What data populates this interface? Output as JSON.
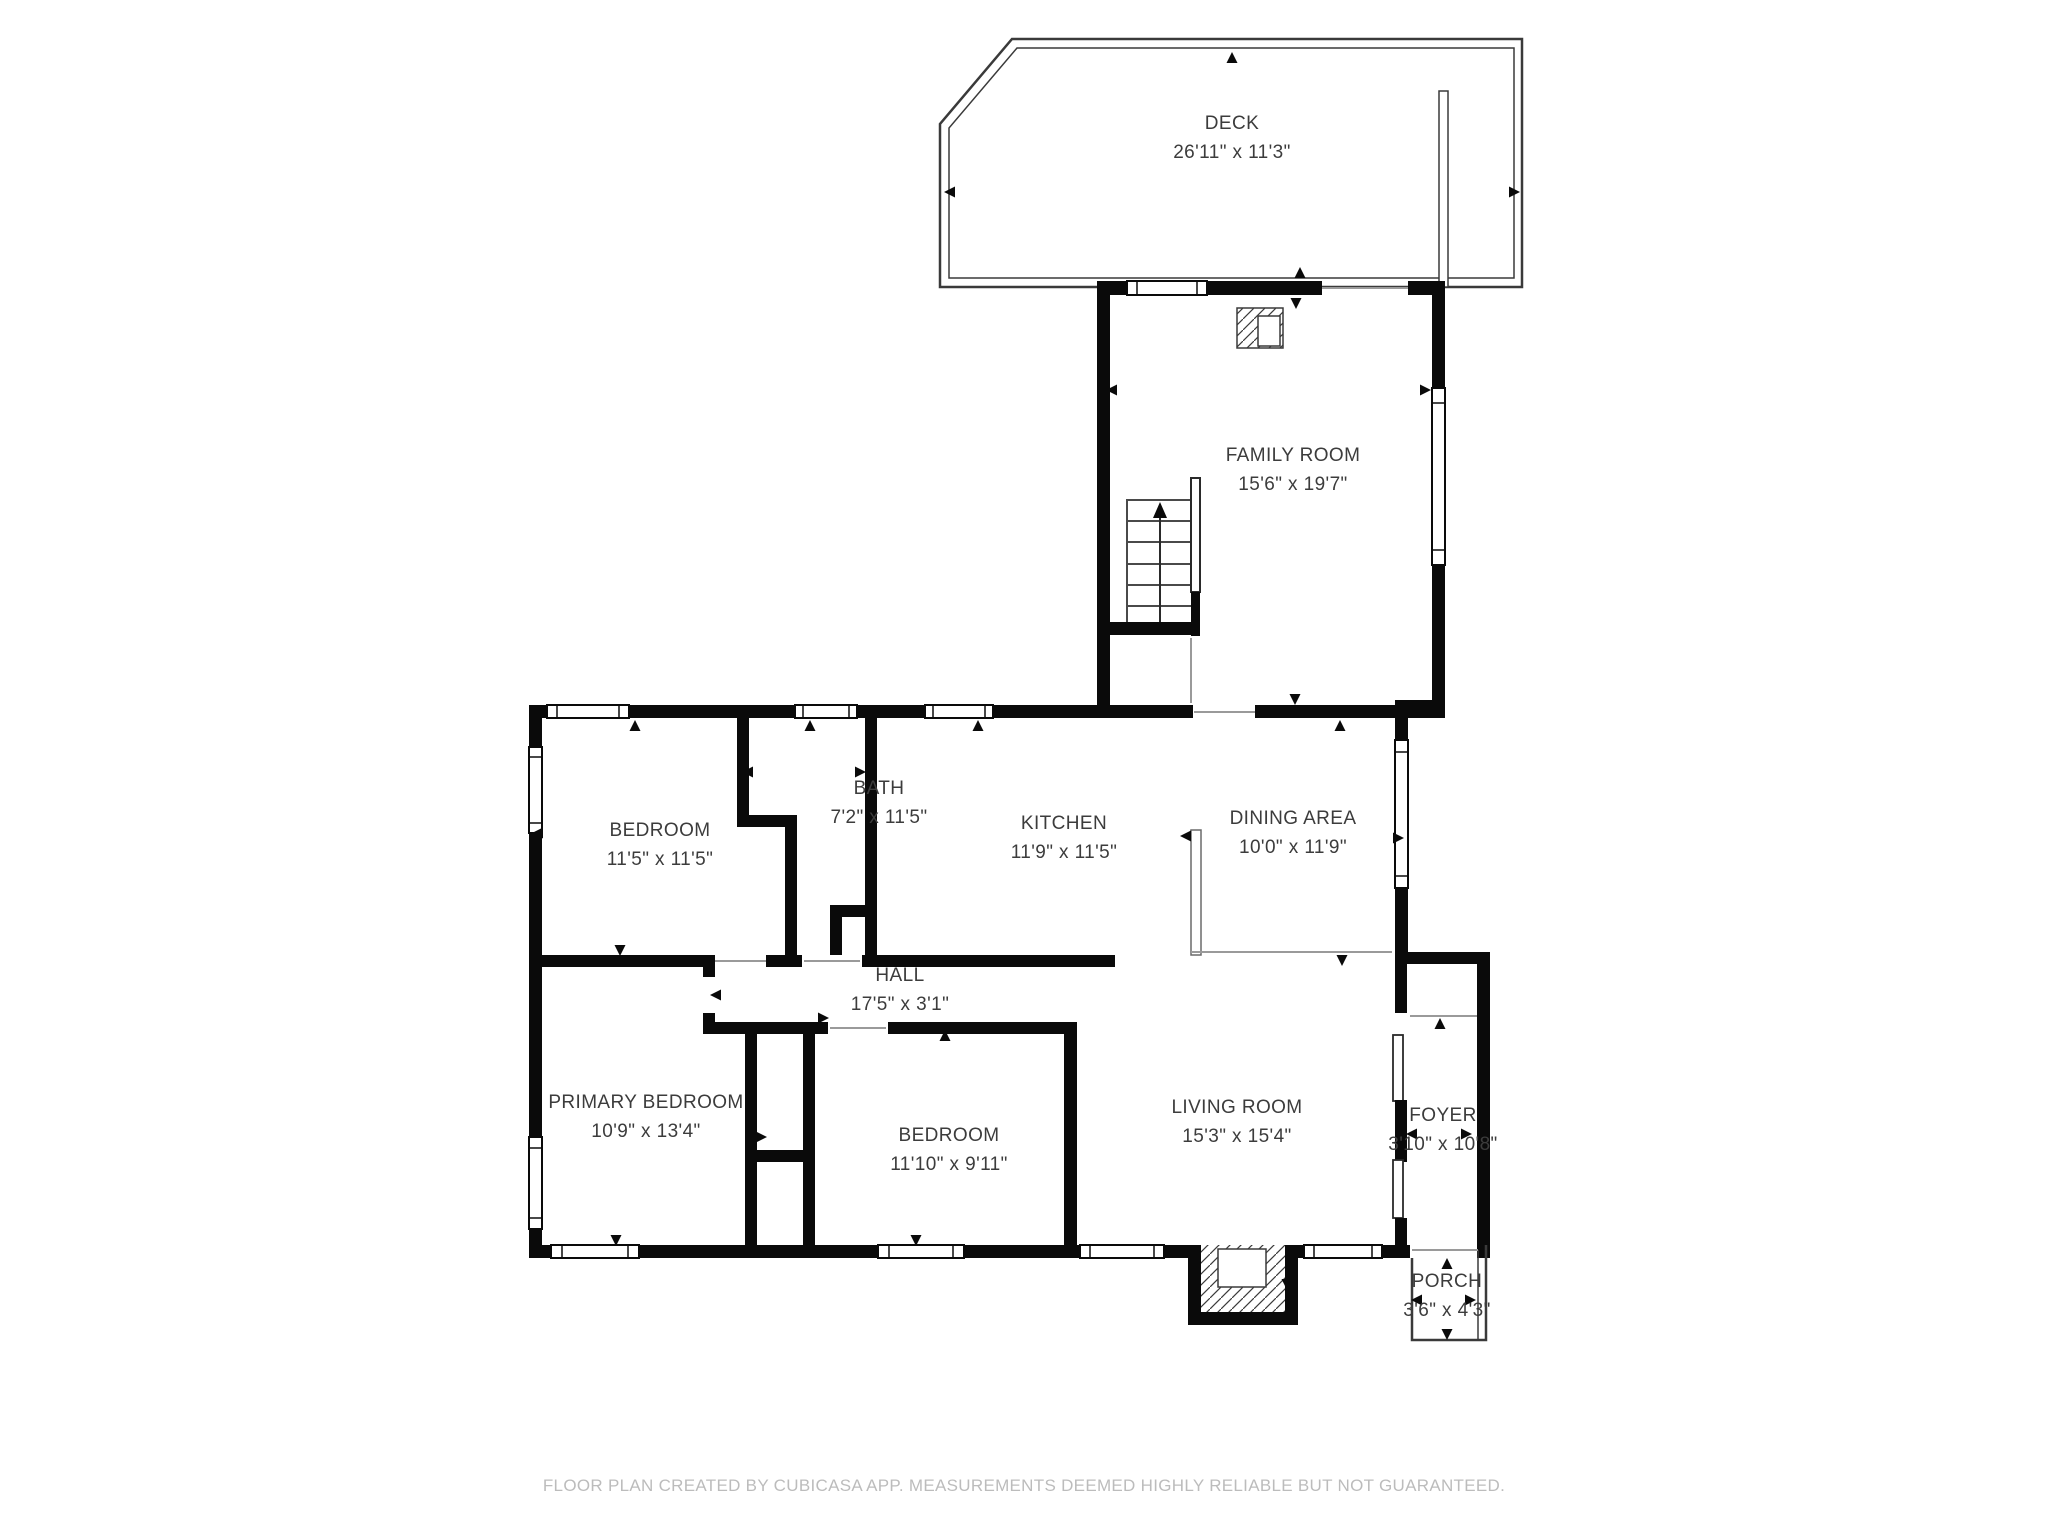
{
  "plan": {
    "type": "floor-plan",
    "colors": {
      "wall": "#0a0a0a",
      "label_text": "#3c3c3c",
      "footer_text": "#bcbcbc",
      "background": "#ffffff"
    }
  },
  "rooms": [
    {
      "id": "deck",
      "name": "DECK",
      "dims": "26'11\" x 11'3\""
    },
    {
      "id": "family-room",
      "name": "FAMILY ROOM",
      "dims": "15'6\" x 19'7\""
    },
    {
      "id": "bedroom-upper",
      "name": "BEDROOM",
      "dims": "11'5\" x 11'5\""
    },
    {
      "id": "bath",
      "name": "BATH",
      "dims": "7'2\" x 11'5\""
    },
    {
      "id": "kitchen",
      "name": "KITCHEN",
      "dims": "11'9\" x 11'5\""
    },
    {
      "id": "dining-area",
      "name": "DINING AREA",
      "dims": "10'0\" x 11'9\""
    },
    {
      "id": "hall",
      "name": "HALL",
      "dims": "17'5\" x 3'1\""
    },
    {
      "id": "primary-bedroom",
      "name": "PRIMARY BEDROOM",
      "dims": "10'9\" x 13'4\""
    },
    {
      "id": "bedroom-lower",
      "name": "BEDROOM",
      "dims": "11'10\" x 9'11\""
    },
    {
      "id": "living-room",
      "name": "LIVING ROOM",
      "dims": "15'3\" x 15'4\""
    },
    {
      "id": "foyer",
      "name": "FOYER",
      "dims": "3'10\" x 10'8\""
    },
    {
      "id": "porch",
      "name": "PORCH",
      "dims": "3'6\" x 4'3\""
    }
  ],
  "footer": {
    "disclaimer": "FLOOR PLAN CREATED BY CUBICASA APP. MEASUREMENTS DEEMED HIGHLY RELIABLE BUT NOT GUARANTEED."
  }
}
